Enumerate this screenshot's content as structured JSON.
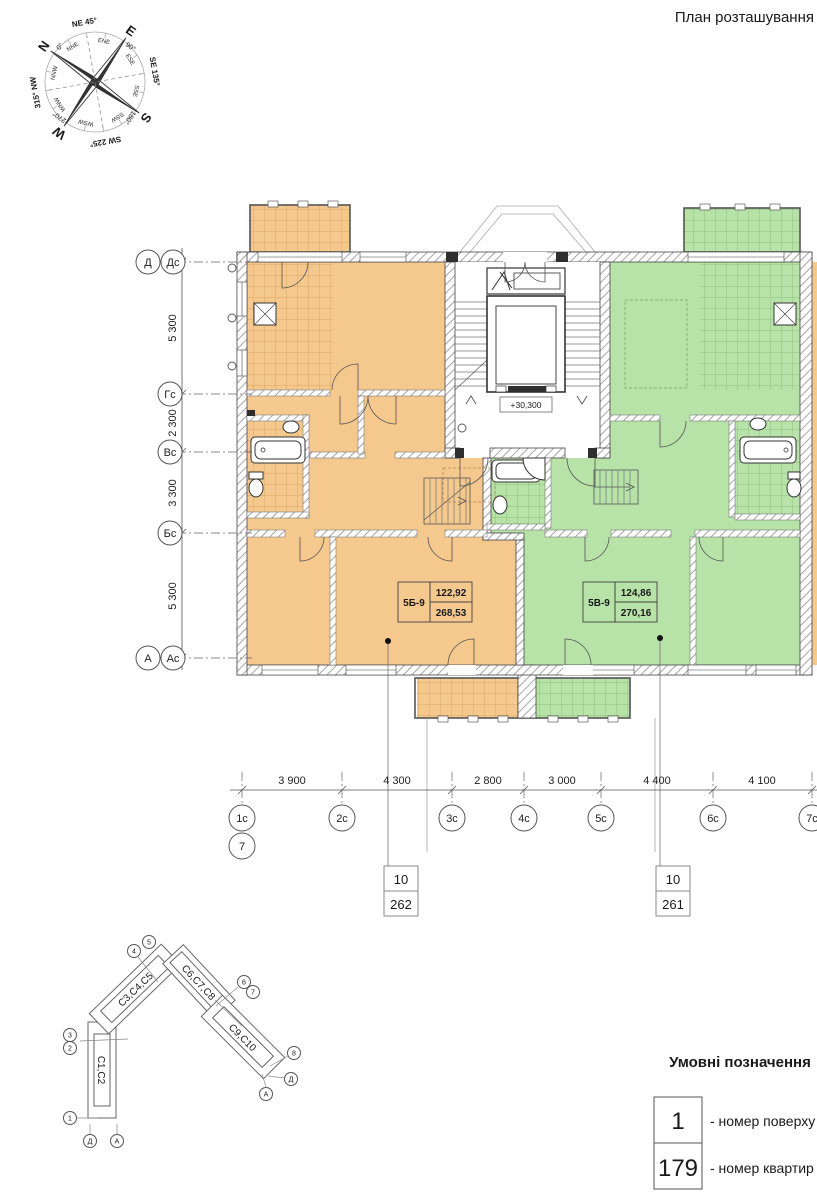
{
  "title": "План розташування",
  "compass": {
    "cardinal": [
      {
        "label": "N",
        "deg": "0°"
      },
      {
        "label": "E",
        "deg": "90°"
      },
      {
        "label": "S",
        "deg": "180°"
      },
      {
        "label": "W",
        "deg": "270°"
      }
    ],
    "intercardinal": [
      "NE 45°",
      "SE 135°",
      "SW 225°",
      "315° NW"
    ],
    "minor": [
      "NNE",
      "ENE",
      "ESE",
      "SSE",
      "SSW",
      "WSW",
      "WNW",
      "NNW"
    ]
  },
  "plan": {
    "elevation": "+30,300",
    "units": [
      {
        "code": "5Б-9",
        "area_upper": "122,92",
        "area_lower": "268,53",
        "color": "#F5C88E"
      },
      {
        "code": "5В-9",
        "area_upper": "124,86",
        "area_lower": "270,16",
        "color": "#B7E2A8"
      }
    ],
    "leaders": [
      {
        "floor": "10",
        "apt": "262"
      },
      {
        "floor": "10",
        "apt": "261"
      }
    ]
  },
  "axes": {
    "left": {
      "bubbles": [
        "Д",
        "Дс",
        "Гс",
        "Вс",
        "Бс",
        "А",
        "Ас"
      ],
      "dims": [
        "5 300",
        "2 300",
        "3 300",
        "5 300"
      ]
    },
    "bottom": {
      "bubbles": [
        "1с",
        "2с",
        "3с",
        "4с",
        "5с",
        "6с",
        "7с"
      ],
      "extra_bubble": "7",
      "dims": [
        "3 900",
        "4 300",
        "2 800",
        "3 000",
        "4 400",
        "4 100"
      ]
    }
  },
  "keyplan": {
    "sections": [
      "С1,С2",
      "С3,С4,С5",
      "С6,С7,С8",
      "С9,С10"
    ],
    "highlighted": "С9,С10",
    "markers": [
      "4",
      "5",
      "3",
      "2",
      "1",
      "Д",
      "А",
      "6",
      "7",
      "8",
      "Д",
      "А"
    ]
  },
  "legend": {
    "heading": "Умовні позначення",
    "items": [
      {
        "symbol": "1",
        "label": "- номер поверху"
      },
      {
        "symbol": "179",
        "label": "- номер квартир"
      }
    ]
  },
  "colors": {
    "unit_left": "#F5C88E",
    "unit_right": "#B7E2A8",
    "keyplan_highlight": "#C4C4C4"
  }
}
